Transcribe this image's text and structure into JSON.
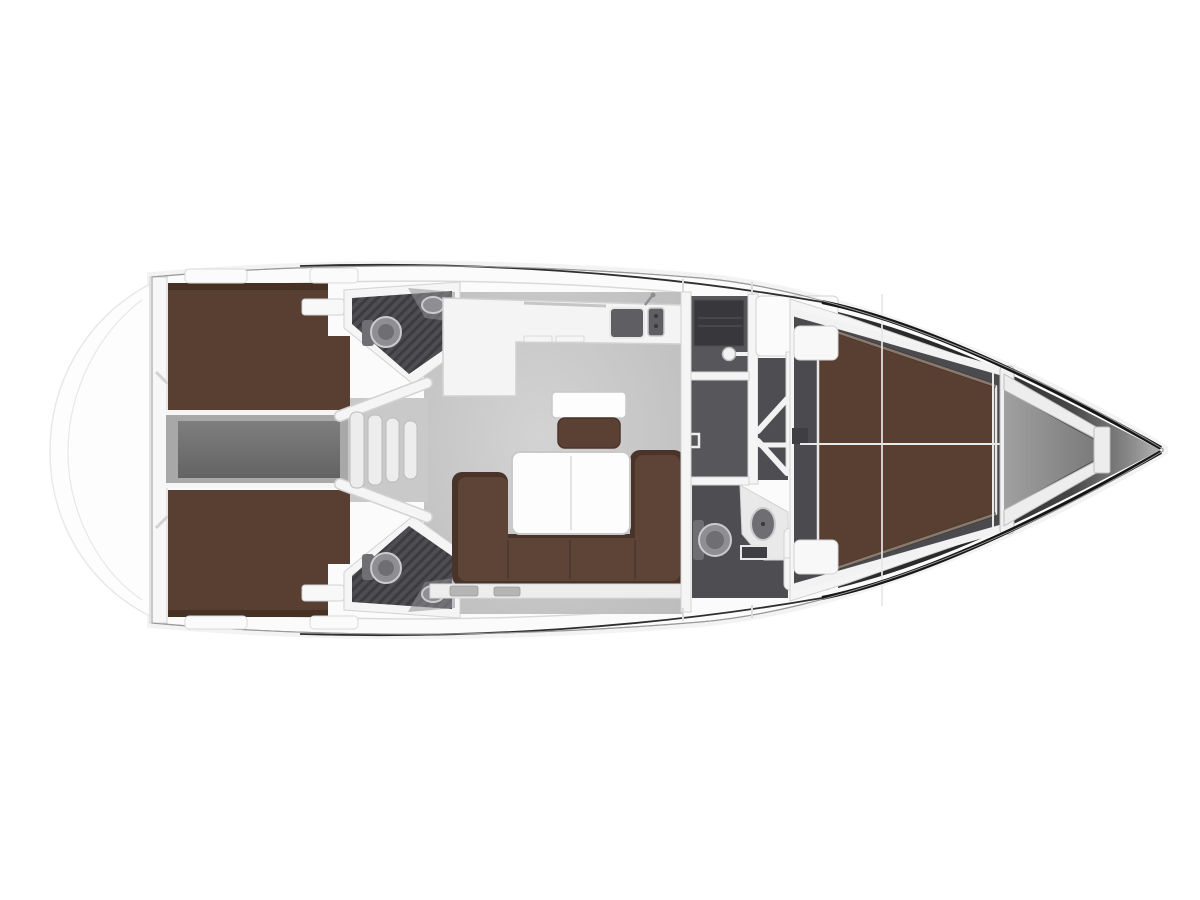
{
  "diagram": {
    "type": "yacht-interior-floor-plan-top-view",
    "orientation": "bow-right-stern-left",
    "regions": [
      {
        "name": "swim-platform",
        "side": "stern"
      },
      {
        "name": "transom"
      },
      {
        "name": "aft-cabin-top",
        "furniture": "double-berth"
      },
      {
        "name": "aft-cabin-bottom",
        "furniture": "double-berth"
      },
      {
        "name": "engine-compartment",
        "position": "centerline-aft"
      },
      {
        "name": "companionway-steps",
        "count": 4
      },
      {
        "name": "aft-head-top",
        "fixtures": [
          "toilet",
          "sink",
          "shower-floor"
        ]
      },
      {
        "name": "aft-head-bottom",
        "fixtures": [
          "toilet",
          "sink",
          "shower-floor"
        ]
      },
      {
        "name": "galley",
        "fixtures": [
          "sink",
          "stove",
          "counter"
        ]
      },
      {
        "name": "chart-table",
        "furniture": [
          "table",
          "seat"
        ]
      },
      {
        "name": "salon",
        "furniture": [
          "u-shaped-sofa",
          "folding-table"
        ]
      },
      {
        "name": "mid-head-shower-room"
      },
      {
        "name": "mid-head-toilet-room",
        "fixtures": [
          "toilet",
          "sink",
          "shower-floor"
        ]
      },
      {
        "name": "wardrobe",
        "symbol": "chevron-arrows"
      },
      {
        "name": "forward-cabin",
        "furniture": "v-double-berth"
      },
      {
        "name": "anchor-locker",
        "side": "bow"
      },
      {
        "name": "bow-tip"
      }
    ]
  },
  "palette": {
    "bg": "#ffffff",
    "shadow": "#e9e9e9",
    "deck": "#fbfbfb",
    "deck_line": "#dadada",
    "hull_stroke": "#9a9a9a",
    "hull_dark": "#161616",
    "hull_mid": "#2e2e2e",
    "transom": "#f7f7f7",
    "swim": "#fdfdfd",
    "swim_stroke": "#e8e8e8",
    "floor_light": "#d3d3d3",
    "floor_edge": "#bdbdbd",
    "under_steps": "#c9c9c9",
    "engine_outer": "#a8a8a8",
    "engine_top": "#7e7e7e",
    "engine_bottom": "#636363",
    "berth": "#583f31",
    "berth_dark": "#463122",
    "pillow": "#f8f8f8",
    "head_base": "#4e4e52",
    "hatch_line": "#3c3c40",
    "head_mid": "#57575b",
    "head_deep": "#38383c",
    "fixture": "#8f8f93",
    "fixture_deep": "#6f6f73",
    "fixture_stroke": "#cbcbce",
    "counter_light": "#e9e9ea",
    "wall": "#f5f5f5",
    "wall_stroke": "#d2d2d2",
    "step": "#ededed",
    "step_stroke": "#bcbcbc",
    "counter": "#f4f4f4",
    "sink_dark": "#5f5f63",
    "table": "#fdfdfd",
    "table_stroke": "#c9c9c9",
    "seat": "#5a4134",
    "sofa": "#5e4436",
    "sofa_dark": "#4a342a",
    "sill": "#ededed",
    "locker_slat": "#b5b5b5",
    "cabin_floor": "#4b4b4f",
    "shelf": "#f2f2f2",
    "bed_frame": "#e8e8e8",
    "bulkhead": "#f1f1f1",
    "locker_a": "#a0a0a0",
    "locker_b": "#7a7a7a",
    "strut": "#ededed",
    "strut_stroke": "#bdbdbd",
    "bow1": "#2f2f2f",
    "bow2": "#272727",
    "bow3": "#474747",
    "bow4": "#8c8c8c",
    "bow5": "#bdbdbd",
    "chev": "#f2f2f2",
    "sq_dark": "#3f3f43",
    "line_light": "#e8e8e8"
  }
}
